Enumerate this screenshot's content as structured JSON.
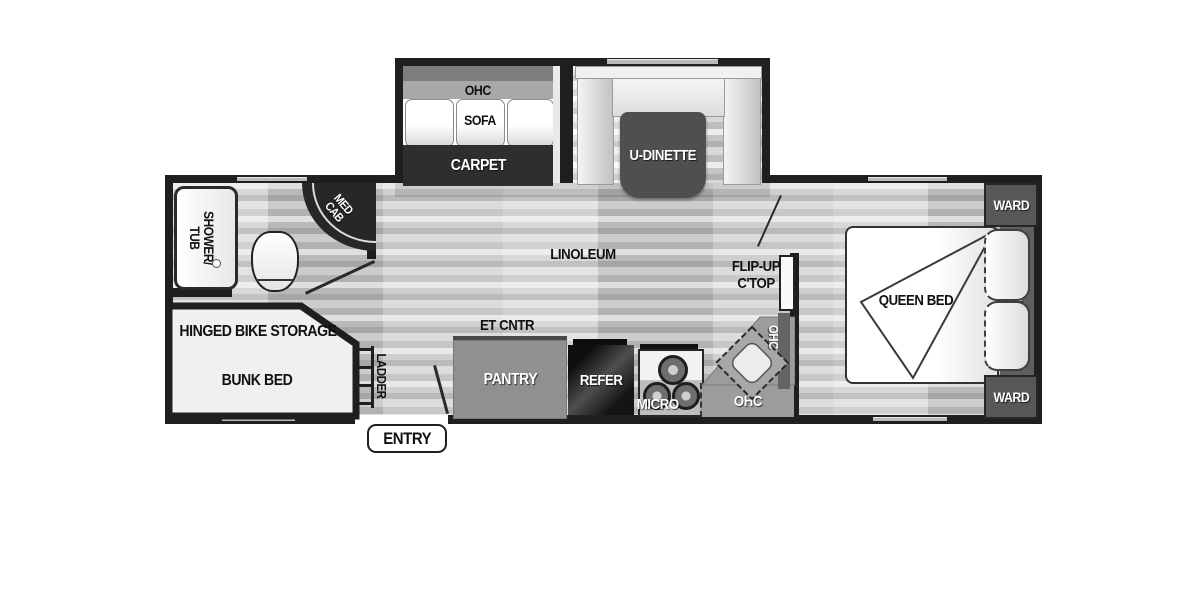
{
  "slide_out": {
    "ohc": "OHC",
    "sofa": "SOFA",
    "carpet": "CARPET",
    "u_dinette": "U-DINETTE"
  },
  "bathroom": {
    "shower_line1": "SHOWER/",
    "shower_line2": "TUB",
    "med_line1": "MED",
    "med_line2": "CAB"
  },
  "front_room": {
    "storage": "HINGED BIKE STORAGE",
    "bunk": "BUNK BED",
    "ladder": "LADDER",
    "entry": "ENTRY"
  },
  "kitchen": {
    "et_cntr": "ET CNTR",
    "pantry": "PANTRY",
    "refer": "REFER",
    "micro": "MICRO",
    "ohc_counter": "OHC",
    "ohc_wall": "OHC",
    "flip_line1": "FLIP-UP",
    "flip_line2": "C'TOP"
  },
  "main_area": {
    "floor": "LINOLEUM"
  },
  "bedroom": {
    "bed": "QUEEN BED",
    "shelf": "SHELF",
    "ward_front": "WARD",
    "ward_rear": "WARD"
  },
  "colors": {
    "wall": "#1f1f1f",
    "carpet": "#2e2e2e",
    "dinette_table": "#4f4f4f",
    "cabinet_gray": "#909090",
    "counter_gray": "#9c9c9c",
    "ward_gray": "#575757"
  }
}
